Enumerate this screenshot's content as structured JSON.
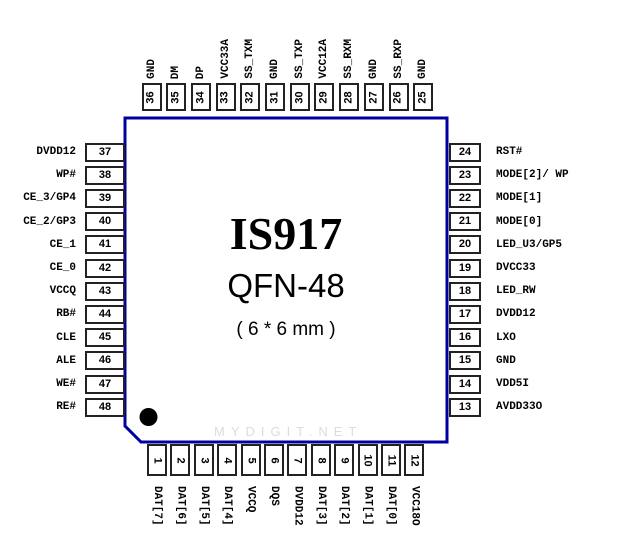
{
  "chip": {
    "part_number": "IS917",
    "package": "QFN-48",
    "dimensions": "( 6 * 6 mm )"
  },
  "watermark": "MYDIGIT.NET",
  "colors": {
    "outline": "#0000a0",
    "pin_border": "#222222",
    "text": "#000000",
    "watermark": "#dcdcdc"
  },
  "pins": {
    "top": [
      {
        "num": "36",
        "label": "GND"
      },
      {
        "num": "35",
        "label": "DM"
      },
      {
        "num": "34",
        "label": "DP"
      },
      {
        "num": "33",
        "label": "VCC33A"
      },
      {
        "num": "32",
        "label": "SS_TXM"
      },
      {
        "num": "31",
        "label": "GND"
      },
      {
        "num": "30",
        "label": "SS_TXP"
      },
      {
        "num": "29",
        "label": "VCC12A"
      },
      {
        "num": "28",
        "label": "SS_RXM"
      },
      {
        "num": "27",
        "label": "GND"
      },
      {
        "num": "26",
        "label": "SS_RXP"
      },
      {
        "num": "25",
        "label": "GND"
      }
    ],
    "left": [
      {
        "num": "37",
        "label": "DVDD12"
      },
      {
        "num": "38",
        "label": "WP#"
      },
      {
        "num": "39",
        "label": "CE_3/GP4"
      },
      {
        "num": "40",
        "label": "CE_2/GP3"
      },
      {
        "num": "41",
        "label": "CE_1"
      },
      {
        "num": "42",
        "label": "CE_0"
      },
      {
        "num": "43",
        "label": "VCCQ"
      },
      {
        "num": "44",
        "label": "RB#"
      },
      {
        "num": "45",
        "label": "CLE"
      },
      {
        "num": "46",
        "label": "ALE"
      },
      {
        "num": "47",
        "label": "WE#"
      },
      {
        "num": "48",
        "label": "RE#"
      }
    ],
    "right": [
      {
        "num": "24",
        "label": "RST#"
      },
      {
        "num": "23",
        "label": "MODE[2]/ WP"
      },
      {
        "num": "22",
        "label": "MODE[1]"
      },
      {
        "num": "21",
        "label": "MODE[0]"
      },
      {
        "num": "20",
        "label": "LED_U3/GP5"
      },
      {
        "num": "19",
        "label": "DVCC33"
      },
      {
        "num": "18",
        "label": "LED_RW"
      },
      {
        "num": "17",
        "label": "DVDD12"
      },
      {
        "num": "16",
        "label": "LXO"
      },
      {
        "num": "15",
        "label": "GND"
      },
      {
        "num": "14",
        "label": "VDD5I"
      },
      {
        "num": "13",
        "label": "AVDD33O"
      }
    ],
    "bottom": [
      {
        "num": "1",
        "label": "DAT[7]"
      },
      {
        "num": "2",
        "label": "DAT[6]"
      },
      {
        "num": "3",
        "label": "DAT[5]"
      },
      {
        "num": "4",
        "label": "DAT[4]"
      },
      {
        "num": "5",
        "label": "VCCQ"
      },
      {
        "num": "6",
        "label": "DQS"
      },
      {
        "num": "7",
        "label": "DVDD12"
      },
      {
        "num": "8",
        "label": "DAT[3]"
      },
      {
        "num": "9",
        "label": "DAT[2]"
      },
      {
        "num": "10",
        "label": "DAT[1]"
      },
      {
        "num": "11",
        "label": "DAT[0]"
      },
      {
        "num": "12",
        "label": "VCC18O"
      }
    ]
  }
}
